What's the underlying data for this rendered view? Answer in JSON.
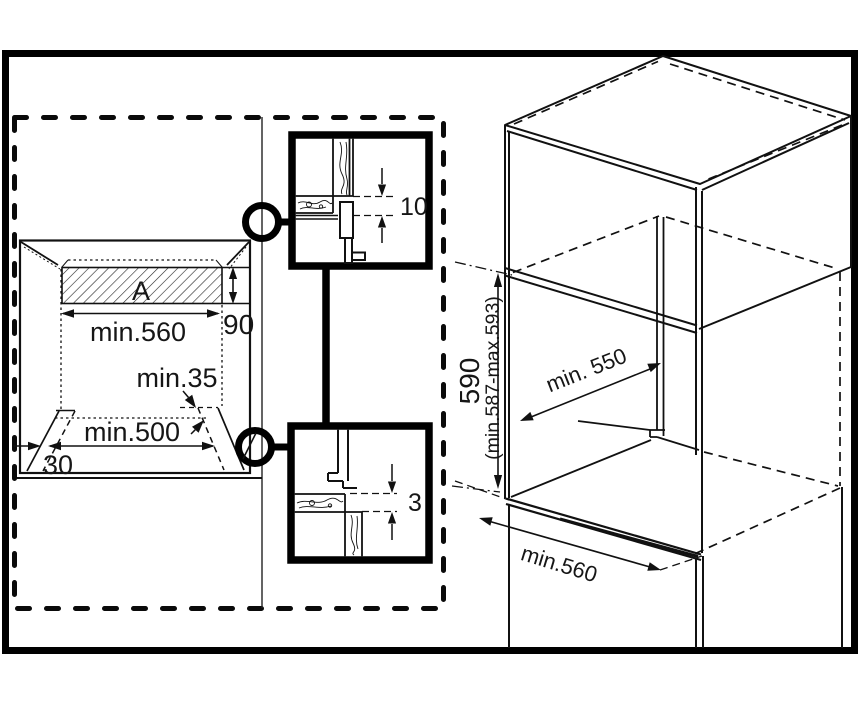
{
  "front_view": {
    "vent_label": "A",
    "vent_height": "90",
    "width_top": "min.560",
    "rear_gap": "min.35",
    "width_bottom": "min.500",
    "plinth_depth": "30"
  },
  "detail_top": {
    "gap": "10"
  },
  "detail_bottom": {
    "gap": "3"
  },
  "perspective": {
    "height": "590",
    "height_range": "(min.587-max.593)",
    "depth": "min. 550",
    "width": "min.560"
  },
  "colors": {
    "line": "#111111",
    "background": "#ffffff"
  }
}
